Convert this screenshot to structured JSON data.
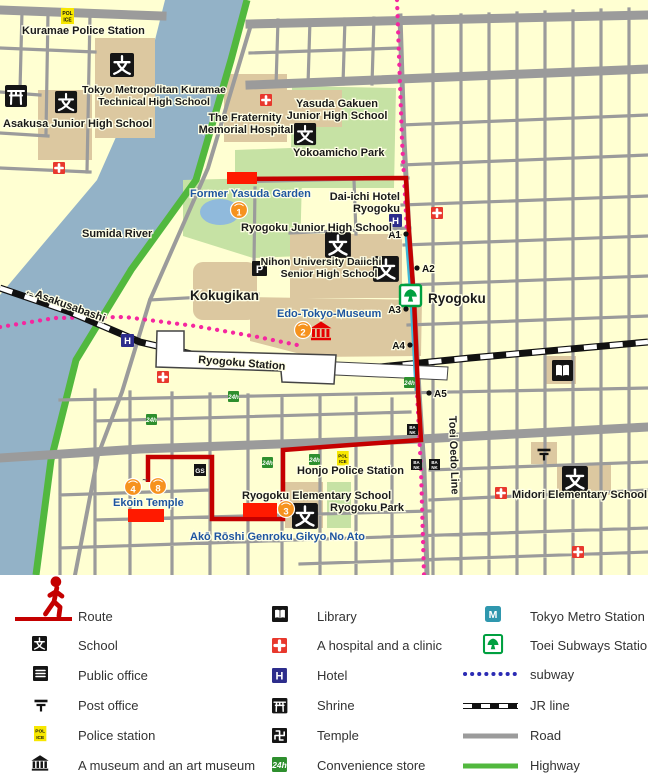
{
  "glyphs": {
    "hotel": "H",
    "parking": "P",
    "gas_station": "GS",
    "convenience": "24h",
    "police_line1": "POL",
    "police_line2": "ICE",
    "bank_line1": "BA",
    "bank_line2": "NK",
    "metro": "M"
  },
  "map_labels": {
    "kuramae_police_station": "Kuramae Police Station",
    "kuramae_tech_hs_1": "Tokyo Metropolitan Kuramae",
    "kuramae_tech_hs_2": "Technical High School",
    "asakusa_jhs": "Asakusa Junior High School",
    "fraternity_1": "The Fraternity",
    "fraternity_2": "Memorial Hospital",
    "yasuda_gakuen_1": "Yasuda Gakuen",
    "yasuda_gakuen_2": "Junior High School",
    "yokoamicho_park": "Yokoamicho Park",
    "daiichi_hotel_1": "Dai-ichi Hotel",
    "daiichi_hotel_2": "Ryogoku",
    "former_yasuda_garden": "Former Yasuda Garden",
    "ryogoku_jhs": "Ryogoku Junior High School",
    "nihon_univ_1": "Nihon University Daiichi",
    "nihon_univ_2": "Senior High School",
    "sumida_river": "Sumida River",
    "asakusabashi": "←Asakusabashi",
    "kokugikan": "Kokugikan",
    "edo_tokyo_museum": "Edo-Tokyo-Museum",
    "ryogoku_station": "Ryogoku Station",
    "ryogoku_toei": "Ryogoku",
    "toei_oedo_line": "Toei Oedo Line",
    "honjo_police_station": "Honjo Police Station",
    "ryogoku_es": "Ryogoku Elementary School",
    "ryogoku_park": "Ryogoku Park",
    "ako_roshi": "Akō Rōshi Genroku Gikyo No Ato",
    "ekoin_temple": "Ekoin Temple",
    "midori_es": "Midori Elementary School"
  },
  "exits": {
    "a1": "A1",
    "a2": "A2",
    "a3": "A3",
    "a4": "A4",
    "a5": "A5"
  },
  "markers": {
    "m1": "1",
    "m2": "2",
    "m3": "3",
    "m4": "4",
    "tilde": "~",
    "m8": "8"
  },
  "legend": {
    "col1": [
      {
        "label": "Route"
      },
      {
        "label": "School"
      },
      {
        "label": "Public office"
      },
      {
        "label": "Post office"
      },
      {
        "label": "Police station"
      },
      {
        "label": "A museum and an art museum"
      }
    ],
    "col2": [
      {
        "label": "Library"
      },
      {
        "label": "A hospital and a clinic"
      },
      {
        "label": "Hotel"
      },
      {
        "label": "Shrine"
      },
      {
        "label": "Temple"
      },
      {
        "label": "Convenience store"
      }
    ],
    "col3": [
      {
        "label": "Tokyo Metro Station"
      },
      {
        "label": "Toei Subways Station"
      },
      {
        "label": "subway"
      },
      {
        "label": "JR line"
      },
      {
        "label": "Road"
      },
      {
        "label": "Highway"
      }
    ]
  },
  "colors": {
    "route_red": "#C40000",
    "highlight_red": "#FF1A00",
    "subway_map_pink": "#F5269F",
    "subway_legend_blue": "#2B2BB4",
    "jr_black": "#111111",
    "road_gray": "#9B9B9B",
    "highway_green": "#52B83E",
    "river_blue": "#93B2C7",
    "park_green": "#C6E2A4",
    "building_tan": "#DCC8A0",
    "block_yellow": "#FFFFD2",
    "marker_orange": "#F6921E",
    "toei_green": "#00A040",
    "metro_teal": "#2F97AE",
    "hotel_blue": "#2D2D8C",
    "hospital_red": "#E8382D",
    "police_yellow": "#F7E700",
    "convenience_green": "#2E8F2E",
    "station_cyan": "#3FB8D8"
  }
}
